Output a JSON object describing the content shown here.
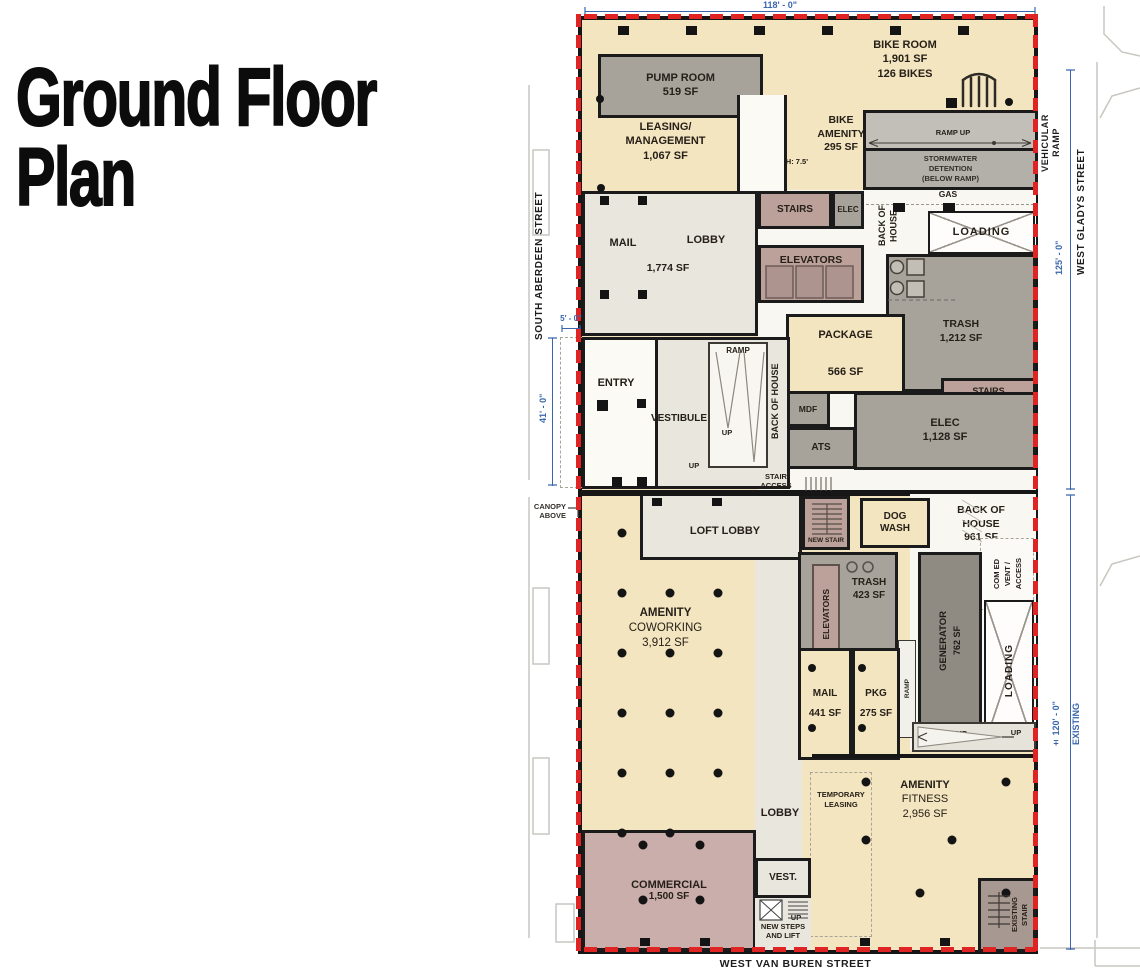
{
  "title": {
    "line1": "Ground Floor",
    "line2": "Plan"
  },
  "streets": {
    "left": "SOUTH ABERDEEN STREET",
    "right": "WEST GLADYS STREET",
    "bottom": "WEST VAN BUREN STREET"
  },
  "dimensions": {
    "top_width": "118' - 0\"",
    "north_height": "125' - 0\"",
    "south_height": "± 120' - 0\"",
    "entry_height": "41' - 0\"",
    "entry_offset": "5' - 0\"",
    "existing": "EXISTING"
  },
  "annotations": {
    "vehicular_ramp_1": "VEHICULAR",
    "vehicular_ramp_2": "RAMP",
    "canopy_1": "CANOPY",
    "canopy_2": "ABOVE",
    "stair_access_1": "STAIR",
    "stair_access_2": "ACCESS",
    "gas": "GAS",
    "ramp_up": "RAMP UP",
    "height_clearance": "H: 7.5'",
    "up": "UP",
    "ramp": "RAMP",
    "back_of_house": "BACK OF HOUSE",
    "new_steps_1": "NEW STEPS",
    "new_steps_2": "AND LIFT",
    "loading": "LOADING"
  },
  "rooms": {
    "pump_room": {
      "name": "PUMP ROOM",
      "area": "519 SF"
    },
    "bike_room": {
      "name": "BIKE ROOM",
      "area": "1,901 SF",
      "capacity": "126 BIKES"
    },
    "leasing": {
      "name1": "LEASING/",
      "name2": "MANAGEMENT",
      "area": "1,067 SF"
    },
    "bike_amenity": {
      "name1": "BIKE",
      "name2": "AMENITY",
      "area": "295 SF"
    },
    "stormwater": {
      "line1": "STORMWATER",
      "line2": "DETENTION",
      "line3": "(BELOW RAMP)"
    },
    "stairs_north": {
      "name": "STAIRS"
    },
    "elec_north": {
      "name": "ELEC"
    },
    "mail_lobby": {
      "mail": "MAIL",
      "lobby": "LOBBY",
      "area": "1,774 SF"
    },
    "elevators_north": {
      "name": "ELEVATORS"
    },
    "trash_north": {
      "name": "TRASH",
      "area": "1,212 SF"
    },
    "stairs_east": {
      "name": "STAIRS"
    },
    "package": {
      "name": "PACKAGE",
      "area": "566 SF"
    },
    "mdf": {
      "name": "MDF"
    },
    "ats": {
      "name": "ATS"
    },
    "elec_east": {
      "name": "ELEC",
      "area": "1,128 SF"
    },
    "entry": {
      "name": "ENTRY"
    },
    "vestibule": {
      "name": "VESTIBULE"
    },
    "loft_lobby": {
      "name": "LOFT LOBBY"
    },
    "new_stair": {
      "name": "NEW STAIR"
    },
    "dog_wash": {
      "name1": "DOG",
      "name2": "WASH"
    },
    "boh_south": {
      "name1": "BACK OF",
      "name2": "HOUSE",
      "area": "961 SF"
    },
    "comed": {
      "line1": "COM ED",
      "line2": "VENT /",
      "line3": "ACCESS"
    },
    "amenity_coworking": {
      "name1": "AMENITY",
      "name2": "COWORKING",
      "area": "3,912 SF"
    },
    "elevators_south": {
      "name": "ELEVATORS"
    },
    "trash_south": {
      "name": "TRASH",
      "area": "423 SF"
    },
    "generator": {
      "name": "GENERATOR",
      "area": "762 SF"
    },
    "mail_south": {
      "name": "MAIL",
      "area": "441 SF"
    },
    "pkg": {
      "name": "PKG",
      "area": "275 SF"
    },
    "lobby_south": {
      "name": "LOBBY"
    },
    "temporary_leasing": {
      "name1": "TEMPORARY",
      "name2": "LEASING"
    },
    "amenity_fitness": {
      "name1": "AMENITY",
      "name2": "FITNESS",
      "area": "2,956 SF"
    },
    "commercial": {
      "name": "COMMERCIAL",
      "area": "1,500 SF"
    },
    "vest_south": {
      "name": "VEST."
    },
    "existing_stair": {
      "name1": "EXISTING",
      "name2": "STAIR"
    }
  },
  "colors": {
    "property_line_red": "#e02424",
    "dimension_blue": "#3a66ad",
    "amenity_cream": "#f3e5bf",
    "service_gray": "#a7a39b",
    "stair_mauve": "#bba19a",
    "commercial_pink": "#c9aeab",
    "lobby_light": "#e9e6de",
    "generator_dark": "#8f8b83",
    "wall_black": "#1b1b1b"
  }
}
